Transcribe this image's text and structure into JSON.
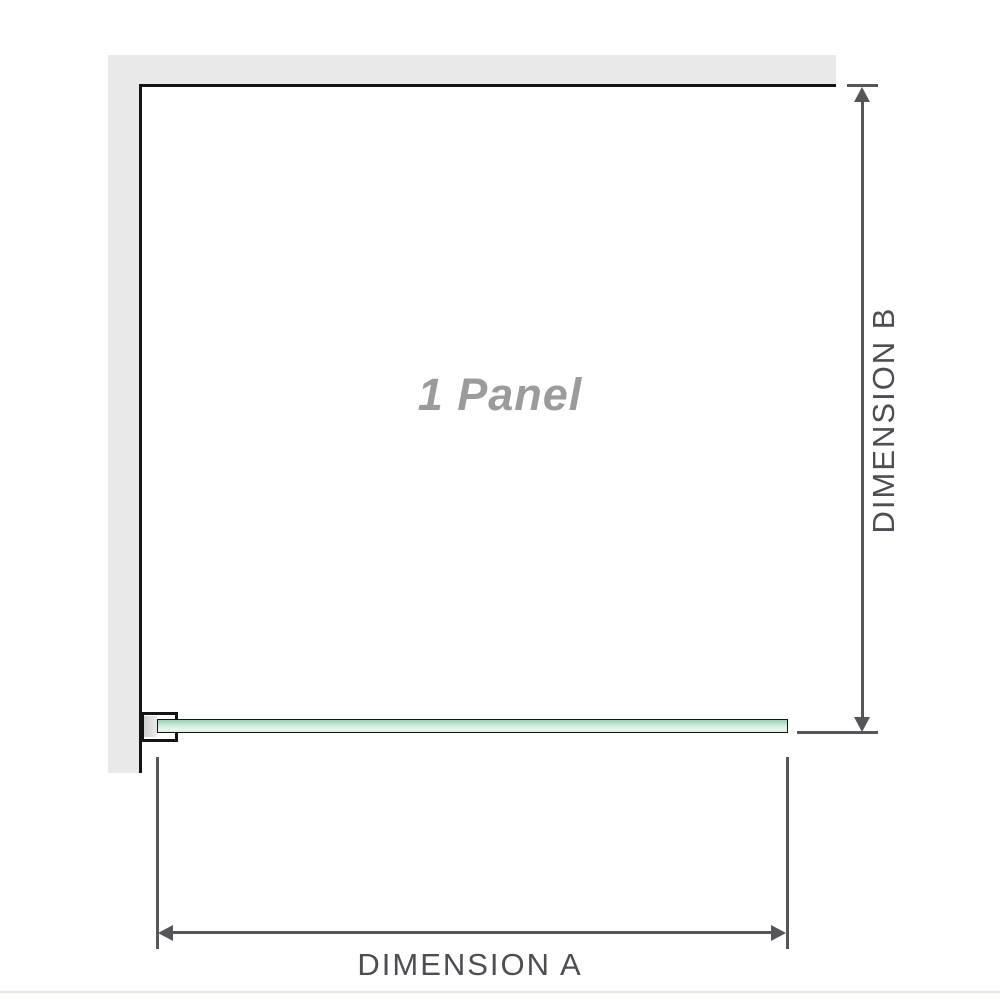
{
  "diagram": {
    "panel_label": "1 Panel",
    "dimension_a_label": "DIMENSION A",
    "dimension_b_label": "DIMENSION B",
    "colors": {
      "wall": "#e9e9e9",
      "outline": "#141414",
      "dimension": "#54565a",
      "glass_top": "#98d0b4",
      "glass_mid": "#cdeada",
      "glass_bottom": "#e6f6ee",
      "panel_label": "#9b9b9b",
      "dim_label": "#4c4e53",
      "baseline": "#e7e4dd"
    }
  }
}
